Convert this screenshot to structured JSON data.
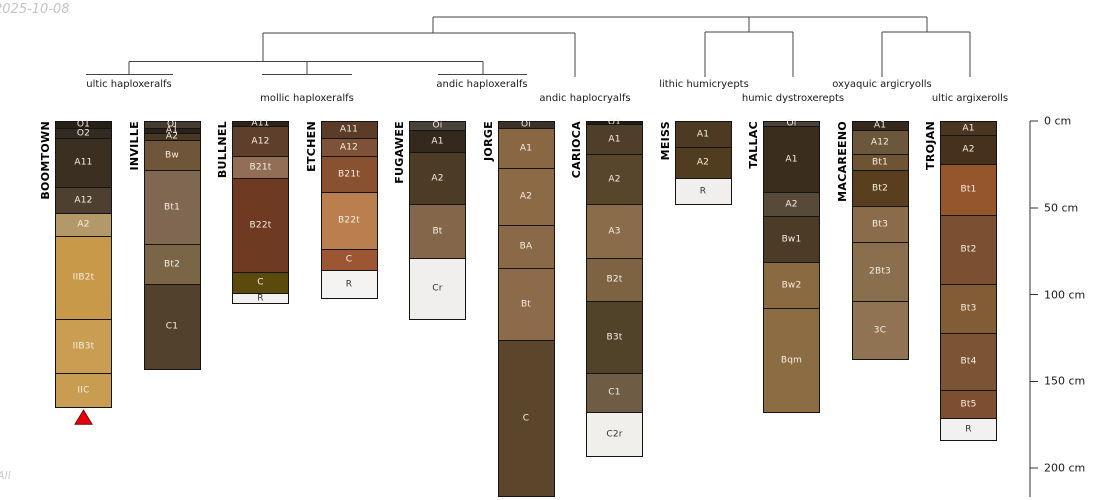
{
  "annotations": {
    "date": "2025-10-08",
    "watermark": "All"
  },
  "marker": {
    "shape": "triangle-up",
    "color": "#e8000d",
    "outline": "#7a0000",
    "below_profile": "BOOMTOWN"
  },
  "chart_data": {
    "type": "soil-profile-columns-with-dendrogram",
    "depth_axis": {
      "unit": "cm",
      "tick_values": [
        0,
        50,
        100,
        150,
        200
      ],
      "tick_labels": [
        "0 cm",
        "50 cm",
        "100 cm",
        "150 cm",
        "200 cm"
      ]
    },
    "dendrogram_leaves": [
      "ultic haploxeralfs",
      "mollic haploxeralfs",
      "andic haploxeralfs",
      "andic haplocryalfs",
      "lithic humicryepts",
      "humic dystroxerepts",
      "oxyaquic argicryolls",
      "ultic argixerolls"
    ],
    "profiles": [
      {
        "name": "BOOMTOWN",
        "horizons": [
          {
            "label": "O1",
            "top_cm": 0,
            "bottom_cm": 4,
            "color": "#262019"
          },
          {
            "label": "O2",
            "top_cm": 4,
            "bottom_cm": 10,
            "color": "#332b21"
          },
          {
            "label": "A11",
            "top_cm": 10,
            "bottom_cm": 38,
            "color": "#3b2f21"
          },
          {
            "label": "A12",
            "top_cm": 38,
            "bottom_cm": 53,
            "color": "#4e4030"
          },
          {
            "label": "A2",
            "top_cm": 53,
            "bottom_cm": 66,
            "color": "#b3986a"
          },
          {
            "label": "IIB2t",
            "top_cm": 66,
            "bottom_cm": 114,
            "color": "#c9994a"
          },
          {
            "label": "IIB3t",
            "top_cm": 114,
            "bottom_cm": 145,
            "color": "#c99d52"
          },
          {
            "label": "IIC",
            "top_cm": 145,
            "bottom_cm": 165,
            "color": "#c89c51"
          }
        ]
      },
      {
        "name": "INVILLE",
        "horizons": [
          {
            "label": "Oi",
            "top_cm": 0,
            "bottom_cm": 4,
            "color": "#453c31"
          },
          {
            "label": "A1",
            "top_cm": 4,
            "bottom_cm": 7,
            "color": "#2b2118"
          },
          {
            "label": "A2",
            "top_cm": 7,
            "bottom_cm": 11,
            "color": "#473921"
          },
          {
            "label": "Bw",
            "top_cm": 11,
            "bottom_cm": 28,
            "color": "#6f5639"
          },
          {
            "label": "Bt1",
            "top_cm": 28,
            "bottom_cm": 71,
            "color": "#806752"
          },
          {
            "label": "Bt2",
            "top_cm": 71,
            "bottom_cm": 94,
            "color": "#7a6547"
          },
          {
            "label": "C1",
            "top_cm": 94,
            "bottom_cm": 143,
            "color": "#52422c"
          }
        ]
      },
      {
        "name": "BULLNEL",
        "horizons": [
          {
            "label": "A11",
            "top_cm": 0,
            "bottom_cm": 3,
            "color": "#2f2317"
          },
          {
            "label": "A12",
            "top_cm": 3,
            "bottom_cm": 20,
            "color": "#5d3f2c"
          },
          {
            "label": "B21t",
            "top_cm": 20,
            "bottom_cm": 33,
            "color": "#916e55"
          },
          {
            "label": "B22t",
            "top_cm": 33,
            "bottom_cm": 87,
            "color": "#6f3a22"
          },
          {
            "label": "C",
            "top_cm": 87,
            "bottom_cm": 99,
            "color": "#5c4a0c"
          },
          {
            "label": "R",
            "top_cm": 99,
            "bottom_cm": 105,
            "color": "#f2f1ef"
          }
        ]
      },
      {
        "name": "ETCHEN",
        "horizons": [
          {
            "label": "A11",
            "top_cm": 0,
            "bottom_cm": 10,
            "color": "#5a3c28"
          },
          {
            "label": "A12",
            "top_cm": 10,
            "bottom_cm": 20,
            "color": "#7d5239"
          },
          {
            "label": "B21t",
            "top_cm": 20,
            "bottom_cm": 41,
            "color": "#8a5130"
          },
          {
            "label": "B22t",
            "top_cm": 41,
            "bottom_cm": 74,
            "color": "#bb7f4f"
          },
          {
            "label": "C",
            "top_cm": 74,
            "bottom_cm": 86,
            "color": "#9d5634"
          },
          {
            "label": "R",
            "top_cm": 86,
            "bottom_cm": 102,
            "color": "#f4f3f1"
          }
        ]
      },
      {
        "name": "FUGAWEE",
        "horizons": [
          {
            "label": "Oi",
            "top_cm": 0,
            "bottom_cm": 5,
            "color": "#4a433c"
          },
          {
            "label": "A1",
            "top_cm": 5,
            "bottom_cm": 18,
            "color": "#33291c"
          },
          {
            "label": "A2",
            "top_cm": 18,
            "bottom_cm": 48,
            "color": "#4c3c26"
          },
          {
            "label": "Bt",
            "top_cm": 48,
            "bottom_cm": 79,
            "color": "#84674b"
          },
          {
            "label": "Cr",
            "top_cm": 79,
            "bottom_cm": 114,
            "color": "#f0efed"
          }
        ]
      },
      {
        "name": "JORGE",
        "horizons": [
          {
            "label": "Oi",
            "top_cm": 0,
            "bottom_cm": 4,
            "color": "#3b332a"
          },
          {
            "label": "A1",
            "top_cm": 4,
            "bottom_cm": 27,
            "color": "#8a6743"
          },
          {
            "label": "A2",
            "top_cm": 27,
            "bottom_cm": 60,
            "color": "#8c6a46"
          },
          {
            "label": "BA",
            "top_cm": 60,
            "bottom_cm": 85,
            "color": "#8a6948"
          },
          {
            "label": "Bt",
            "top_cm": 85,
            "bottom_cm": 126,
            "color": "#8d6a4a"
          },
          {
            "label": "C",
            "top_cm": 126,
            "bottom_cm": 216,
            "color": "#5c462b"
          }
        ]
      },
      {
        "name": "CARIOCA",
        "horizons": [
          {
            "label": "O1",
            "top_cm": 0,
            "bottom_cm": 2,
            "color": "#201b15"
          },
          {
            "label": "A1",
            "top_cm": 2,
            "bottom_cm": 19,
            "color": "#4e3e2a"
          },
          {
            "label": "A2",
            "top_cm": 19,
            "bottom_cm": 48,
            "color": "#57452c"
          },
          {
            "label": "A3",
            "top_cm": 48,
            "bottom_cm": 79,
            "color": "#8a6c4a"
          },
          {
            "label": "B2t",
            "top_cm": 79,
            "bottom_cm": 104,
            "color": "#7d6341"
          },
          {
            "label": "B3t",
            "top_cm": 104,
            "bottom_cm": 145,
            "color": "#51422a"
          },
          {
            "label": "C1",
            "top_cm": 145,
            "bottom_cm": 168,
            "color": "#6e5c44"
          },
          {
            "label": "C2r",
            "top_cm": 168,
            "bottom_cm": 193,
            "color": "#f0efec"
          }
        ]
      },
      {
        "name": "MEISS",
        "horizons": [
          {
            "label": "A1",
            "top_cm": 0,
            "bottom_cm": 15,
            "color": "#4e3a22"
          },
          {
            "label": "A2",
            "top_cm": 15,
            "bottom_cm": 33,
            "color": "#523c20"
          },
          {
            "label": "R",
            "top_cm": 33,
            "bottom_cm": 48,
            "color": "#f0efed"
          }
        ]
      },
      {
        "name": "TALLAC",
        "horizons": [
          {
            "label": "Oi",
            "top_cm": 0,
            "bottom_cm": 3,
            "color": "#49413a"
          },
          {
            "label": "A1",
            "top_cm": 3,
            "bottom_cm": 41,
            "color": "#3a2d1e"
          },
          {
            "label": "A2",
            "top_cm": 41,
            "bottom_cm": 55,
            "color": "#584a39"
          },
          {
            "label": "Bw1",
            "top_cm": 55,
            "bottom_cm": 81,
            "color": "#4c3b27"
          },
          {
            "label": "Bw2",
            "top_cm": 81,
            "bottom_cm": 108,
            "color": "#8a6a40"
          },
          {
            "label": "Bqm",
            "top_cm": 108,
            "bottom_cm": 168,
            "color": "#8c6c42"
          }
        ]
      },
      {
        "name": "MACAREENO",
        "horizons": [
          {
            "label": "A1",
            "top_cm": 0,
            "bottom_cm": 5,
            "color": "#34291a"
          },
          {
            "label": "A12",
            "top_cm": 5,
            "bottom_cm": 19,
            "color": "#6b573c"
          },
          {
            "label": "Bt1",
            "top_cm": 19,
            "bottom_cm": 28,
            "color": "#6f5434"
          },
          {
            "label": "Bt2",
            "top_cm": 28,
            "bottom_cm": 49,
            "color": "#5a3f1e"
          },
          {
            "label": "Bt3",
            "top_cm": 49,
            "bottom_cm": 70,
            "color": "#8a6c4a"
          },
          {
            "label": "2Bt3",
            "top_cm": 70,
            "bottom_cm": 104,
            "color": "#8a6f4e"
          },
          {
            "label": "3C",
            "top_cm": 104,
            "bottom_cm": 137,
            "color": "#8f7352"
          }
        ]
      },
      {
        "name": "TROJAN",
        "horizons": [
          {
            "label": "A1",
            "top_cm": 0,
            "bottom_cm": 8,
            "color": "#4a3521"
          },
          {
            "label": "A2",
            "top_cm": 8,
            "bottom_cm": 25,
            "color": "#46311d"
          },
          {
            "label": "Bt1",
            "top_cm": 25,
            "bottom_cm": 54,
            "color": "#95562c"
          },
          {
            "label": "Bt2",
            "top_cm": 54,
            "bottom_cm": 94,
            "color": "#7b4f31"
          },
          {
            "label": "Bt3",
            "top_cm": 94,
            "bottom_cm": 122,
            "color": "#815c35"
          },
          {
            "label": "Bt4",
            "top_cm": 122,
            "bottom_cm": 155,
            "color": "#7b5335"
          },
          {
            "label": "Bt5",
            "top_cm": 155,
            "bottom_cm": 171,
            "color": "#7d4f30"
          },
          {
            "label": "R",
            "top_cm": 171,
            "bottom_cm": 184,
            "color": "#f2f1ef"
          }
        ]
      }
    ]
  }
}
